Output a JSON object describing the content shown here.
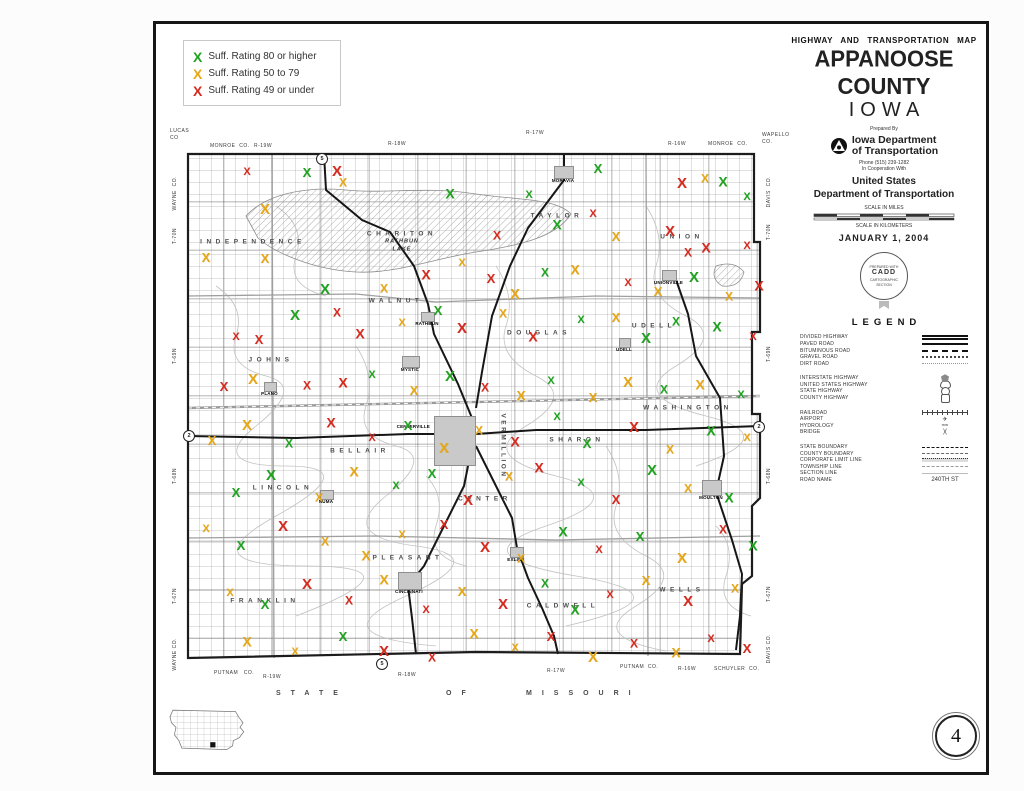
{
  "sheet": {
    "page_number": "4"
  },
  "suff_legend": {
    "items": [
      {
        "x_color": "#1fa31f",
        "label": "Suff. Rating 80 or higher"
      },
      {
        "x_color": "#e7a715",
        "label": "Suff. Rating 50 to 79"
      },
      {
        "x_color": "#d62a1f",
        "label": "Suff. Rating 49 or under"
      }
    ]
  },
  "title_block": {
    "map_type": "HIGHWAY AND TRANSPORTATION MAP",
    "county": "APPANOOSE COUNTY",
    "state": "IOWA",
    "prepared_by": "Prepared By",
    "agency_line1": "Iowa Department",
    "agency_line2": "of Transportation",
    "phone": "Phone (515) 239-1282",
    "cooperation": "In Cooperation With",
    "us_line1": "United States",
    "us_line2": "Department of Transportation",
    "scale_miles": "SCALE IN MILES",
    "scale_km": "SCALE IN KILOMETERS",
    "date": "JANUARY 1, 2004",
    "seal_line1": "PREPARED WITH",
    "seal_line2": "CADD",
    "seal_line3": "CARTOGRAPHIC",
    "seal_line4": "SECTION"
  },
  "legend": {
    "heading": "LEGEND",
    "groups": [
      {
        "items": [
          {
            "label": "DIVIDED HIGHWAY",
            "sym": "divided"
          },
          {
            "label": "PAVED ROAD",
            "sym": "paved"
          },
          {
            "label": "BITUMINOUS ROAD",
            "sym": "bituminous"
          },
          {
            "label": "GRAVEL ROAD",
            "sym": "gravel"
          },
          {
            "label": "DIRT ROAD",
            "sym": "dirt"
          }
        ]
      },
      {
        "items": [
          {
            "label": "INTERSTATE HIGHWAY",
            "sym": "interstate"
          },
          {
            "label": "UNITED STATES HIGHWAY",
            "sym": "us"
          },
          {
            "label": "STATE HIGHWAY",
            "sym": "state"
          },
          {
            "label": "COUNTY HIGHWAY",
            "sym": "county"
          }
        ]
      },
      {
        "items": [
          {
            "label": "RAILROAD",
            "sym": "railroad"
          },
          {
            "label": "AIRPORT",
            "sym": "glyph",
            "glyph": "✈"
          },
          {
            "label": "HYDROLOGY",
            "sym": "glyph",
            "glyph": "≈≈"
          },
          {
            "label": "BRIDGE",
            "sym": "glyph",
            "glyph": ")("
          }
        ]
      },
      {
        "items": [
          {
            "label": "STATE BOUNDARY",
            "sym": "stateb"
          },
          {
            "label": "COUNTY BOUNDARY",
            "sym": "countyb"
          },
          {
            "label": "CORPORATE LIMIT LINE",
            "sym": "corp"
          },
          {
            "label": "TOWNSHIP LINE",
            "sym": "townline"
          },
          {
            "label": "SECTION LINE",
            "sym": "sectline"
          },
          {
            "label": "ROAD NAME",
            "sym": "glyph",
            "glyph": "240TH ST"
          }
        ]
      }
    ]
  },
  "map": {
    "townships": [
      {
        "n": "INDEPENDENCE",
        "x": 77,
        "y": 96
      },
      {
        "n": "CHARITON",
        "x": 226,
        "y": 88
      },
      {
        "n": "TAYLOR",
        "x": 381,
        "y": 70
      },
      {
        "n": "UNION",
        "x": 506,
        "y": 91
      },
      {
        "n": "JOHNS",
        "x": 95,
        "y": 214
      },
      {
        "n": "WALNUT",
        "x": 220,
        "y": 155
      },
      {
        "n": "DOUGLAS",
        "x": 363,
        "y": 187
      },
      {
        "n": "UDELL",
        "x": 478,
        "y": 180
      },
      {
        "n": "WASHINGTON",
        "x": 512,
        "y": 262
      },
      {
        "n": "LINCOLN",
        "x": 107,
        "y": 342
      },
      {
        "n": "BELLAIR",
        "x": 184,
        "y": 305
      },
      {
        "n": "VERMILLION",
        "x": 327,
        "y": 300,
        "vert": true
      },
      {
        "n": "SHARON",
        "x": 401,
        "y": 294
      },
      {
        "n": "CENTER",
        "x": 309,
        "y": 353
      },
      {
        "n": "PLEASANT",
        "x": 232,
        "y": 412
      },
      {
        "n": "FRANKLIN",
        "x": 89,
        "y": 455
      },
      {
        "n": "CALDWELL",
        "x": 387,
        "y": 460
      },
      {
        "n": "WELLS",
        "x": 506,
        "y": 444
      }
    ],
    "lake_label": {
      "line1": "RATHBUN",
      "line2": "LAKE",
      "x": 226,
      "y": 100
    },
    "towns": [
      {
        "n": "MORAVIA",
        "x": 378,
        "y": 20,
        "w": 18,
        "h": 11
      },
      {
        "n": "UNIONVILLE",
        "x": 486,
        "y": 124,
        "w": 13,
        "h": 9
      },
      {
        "n": "RATHBUN",
        "x": 245,
        "y": 166,
        "w": 12,
        "h": 8
      },
      {
        "n": "UDELL",
        "x": 443,
        "y": 192,
        "w": 10,
        "h": 8
      },
      {
        "n": "MYSTIC",
        "x": 226,
        "y": 210,
        "w": 16,
        "h": 10
      },
      {
        "n": "PLANO",
        "x": 88,
        "y": 236,
        "w": 11,
        "h": 8
      },
      {
        "n": "CENTERVILLE",
        "x": 258,
        "y": 270,
        "w": 40,
        "h": 48,
        "lp": "left"
      },
      {
        "n": "NUMA",
        "x": 144,
        "y": 344,
        "w": 12,
        "h": 8
      },
      {
        "n": "MOULTON",
        "x": 526,
        "y": 334,
        "w": 18,
        "h": 14
      },
      {
        "n": "EXLINE",
        "x": 334,
        "y": 401,
        "w": 12,
        "h": 9
      },
      {
        "n": "CINCINNATI",
        "x": 222,
        "y": 426,
        "w": 22,
        "h": 16
      }
    ],
    "route_shields": [
      {
        "n": "5",
        "x": 146,
        "y": 13
      },
      {
        "n": "2",
        "x": 13,
        "y": 290
      },
      {
        "n": "5",
        "x": 206,
        "y": 518
      },
      {
        "n": "2",
        "x": 583,
        "y": 281
      }
    ],
    "edges": {
      "top": [
        {
          "t": "LUCAS\nCO",
          "x": 0,
          "y": 4
        },
        {
          "t": "MONROE  CO.",
          "x": 40,
          "y": 19
        },
        {
          "t": "R-19W",
          "x": 84,
          "y": 19
        },
        {
          "t": "R-18W",
          "x": 218,
          "y": 17
        },
        {
          "t": "R-17W",
          "x": 356,
          "y": 6
        },
        {
          "t": "R-16W",
          "x": 498,
          "y": 17
        },
        {
          "t": "MONROE  CO.",
          "x": 538,
          "y": 17
        },
        {
          "t": "WAPELLO\nCO.",
          "x": 592,
          "y": 8
        }
      ],
      "bottom": [
        {
          "t": "PUTNAM   CO.",
          "x": 44,
          "y": 546
        },
        {
          "t": "R-19W",
          "x": 93,
          "y": 550
        },
        {
          "t": "R-18W",
          "x": 228,
          "y": 548
        },
        {
          "t": "R-17W",
          "x": 377,
          "y": 544
        },
        {
          "t": "PUTNAM  CO.",
          "x": 450,
          "y": 540
        },
        {
          "t": "R-16W",
          "x": 508,
          "y": 542
        },
        {
          "t": "SCHUYLER  CO.",
          "x": 544,
          "y": 542
        }
      ],
      "left": [
        {
          "t": "WAYNE  CO.",
          "x": 2,
          "y": 52
        },
        {
          "t": "T-70N",
          "x": 2,
          "y": 104
        },
        {
          "t": "T-69N",
          "x": 2,
          "y": 224
        },
        {
          "t": "T-68N",
          "x": 2,
          "y": 344
        },
        {
          "t": "T-67N",
          "x": 2,
          "y": 464
        },
        {
          "t": "WAYNE CO.",
          "x": 2,
          "y": 514
        }
      ],
      "right": [
        {
          "t": "DAVIS  CO.",
          "x": 596,
          "y": 52
        },
        {
          "t": "T-70N",
          "x": 596,
          "y": 100
        },
        {
          "t": "T-69N",
          "x": 596,
          "y": 222
        },
        {
          "t": "T-68N",
          "x": 596,
          "y": 344
        },
        {
          "t": "T-67N",
          "x": 596,
          "y": 462
        },
        {
          "t": "DAVIS CO.",
          "x": 596,
          "y": 510
        }
      ]
    },
    "missouri": {
      "y": 566,
      "parts": [
        {
          "t": "STATE",
          "x": 106
        },
        {
          "t": "OF",
          "x": 276
        },
        {
          "t": "MISSOURI",
          "x": 356
        }
      ]
    },
    "marks": [
      [
        71,
        27,
        "r"
      ],
      [
        131,
        27,
        "g"
      ],
      [
        161,
        26,
        "r"
      ],
      [
        167,
        37,
        "y"
      ],
      [
        274,
        48,
        "g"
      ],
      [
        353,
        50,
        "g"
      ],
      [
        422,
        23,
        "g"
      ],
      [
        506,
        38,
        "r"
      ],
      [
        529,
        33,
        "y"
      ],
      [
        547,
        36,
        "g"
      ],
      [
        571,
        52,
        "g"
      ],
      [
        30,
        112,
        "y"
      ],
      [
        89,
        64,
        "y"
      ],
      [
        321,
        90,
        "r"
      ],
      [
        381,
        79,
        "g"
      ],
      [
        417,
        69,
        "r"
      ],
      [
        440,
        91,
        "y"
      ],
      [
        494,
        86,
        "r"
      ],
      [
        512,
        107,
        "r"
      ],
      [
        530,
        102,
        "r"
      ],
      [
        571,
        101,
        "r"
      ],
      [
        89,
        113,
        "y"
      ],
      [
        149,
        144,
        "g"
      ],
      [
        208,
        143,
        "y"
      ],
      [
        250,
        129,
        "r"
      ],
      [
        286,
        118,
        "y"
      ],
      [
        315,
        133,
        "r"
      ],
      [
        339,
        149,
        "y"
      ],
      [
        369,
        127,
        "g"
      ],
      [
        399,
        124,
        "y"
      ],
      [
        452,
        138,
        "r"
      ],
      [
        482,
        146,
        "y"
      ],
      [
        518,
        132,
        "g"
      ],
      [
        553,
        151,
        "y"
      ],
      [
        583,
        140,
        "r"
      ],
      [
        60,
        192,
        "r"
      ],
      [
        83,
        194,
        "r"
      ],
      [
        119,
        170,
        "g"
      ],
      [
        161,
        167,
        "r"
      ],
      [
        184,
        188,
        "r"
      ],
      [
        226,
        178,
        "y"
      ],
      [
        262,
        165,
        "g"
      ],
      [
        286,
        183,
        "r"
      ],
      [
        327,
        168,
        "y"
      ],
      [
        357,
        191,
        "r"
      ],
      [
        405,
        175,
        "g"
      ],
      [
        440,
        172,
        "y"
      ],
      [
        470,
        193,
        "g"
      ],
      [
        500,
        176,
        "g"
      ],
      [
        541,
        181,
        "g"
      ],
      [
        577,
        192,
        "r"
      ],
      [
        48,
        241,
        "r"
      ],
      [
        77,
        234,
        "y"
      ],
      [
        131,
        240,
        "r"
      ],
      [
        167,
        237,
        "r"
      ],
      [
        196,
        230,
        "g"
      ],
      [
        238,
        245,
        "y"
      ],
      [
        274,
        231,
        "g"
      ],
      [
        309,
        242,
        "r"
      ],
      [
        345,
        250,
        "y"
      ],
      [
        375,
        236,
        "g"
      ],
      [
        417,
        252,
        "y"
      ],
      [
        452,
        237,
        "y"
      ],
      [
        488,
        244,
        "g"
      ],
      [
        524,
        239,
        "y"
      ],
      [
        565,
        250,
        "g"
      ],
      [
        36,
        295,
        "y"
      ],
      [
        71,
        280,
        "y"
      ],
      [
        113,
        298,
        "g"
      ],
      [
        155,
        277,
        "r"
      ],
      [
        196,
        293,
        "r"
      ],
      [
        232,
        280,
        "g"
      ],
      [
        268,
        303,
        "y"
      ],
      [
        303,
        285,
        "y"
      ],
      [
        339,
        296,
        "r"
      ],
      [
        381,
        272,
        "g"
      ],
      [
        411,
        298,
        "g"
      ],
      [
        458,
        282,
        "r"
      ],
      [
        494,
        304,
        "y"
      ],
      [
        535,
        285,
        "g"
      ],
      [
        571,
        293,
        "y"
      ],
      [
        60,
        347,
        "g"
      ],
      [
        95,
        330,
        "g"
      ],
      [
        143,
        352,
        "y"
      ],
      [
        178,
        326,
        "y"
      ],
      [
        220,
        341,
        "g"
      ],
      [
        256,
        328,
        "g"
      ],
      [
        292,
        355,
        "r"
      ],
      [
        333,
        331,
        "y"
      ],
      [
        363,
        322,
        "r"
      ],
      [
        405,
        338,
        "g"
      ],
      [
        440,
        354,
        "r"
      ],
      [
        476,
        325,
        "g"
      ],
      [
        512,
        343,
        "y"
      ],
      [
        553,
        352,
        "g"
      ],
      [
        30,
        384,
        "y"
      ],
      [
        65,
        400,
        "g"
      ],
      [
        107,
        381,
        "r"
      ],
      [
        149,
        396,
        "y"
      ],
      [
        190,
        410,
        "y"
      ],
      [
        226,
        390,
        "y"
      ],
      [
        268,
        379,
        "r"
      ],
      [
        309,
        402,
        "r"
      ],
      [
        345,
        413,
        "y"
      ],
      [
        387,
        386,
        "g"
      ],
      [
        423,
        405,
        "r"
      ],
      [
        464,
        391,
        "g"
      ],
      [
        506,
        413,
        "y"
      ],
      [
        547,
        384,
        "r"
      ],
      [
        577,
        400,
        "g"
      ],
      [
        54,
        448,
        "y"
      ],
      [
        89,
        459,
        "g"
      ],
      [
        131,
        439,
        "r"
      ],
      [
        173,
        455,
        "r"
      ],
      [
        208,
        434,
        "y"
      ],
      [
        250,
        465,
        "r"
      ],
      [
        286,
        446,
        "y"
      ],
      [
        327,
        459,
        "r"
      ],
      [
        369,
        438,
        "g"
      ],
      [
        399,
        464,
        "g"
      ],
      [
        434,
        450,
        "r"
      ],
      [
        470,
        435,
        "y"
      ],
      [
        512,
        456,
        "r"
      ],
      [
        559,
        443,
        "y"
      ],
      [
        71,
        496,
        "y"
      ],
      [
        119,
        507,
        "y"
      ],
      [
        167,
        491,
        "g"
      ],
      [
        208,
        506,
        "r"
      ],
      [
        256,
        512,
        "r"
      ],
      [
        298,
        488,
        "y"
      ],
      [
        339,
        503,
        "y"
      ],
      [
        375,
        491,
        "r"
      ],
      [
        417,
        512,
        "y"
      ],
      [
        458,
        498,
        "r"
      ],
      [
        500,
        507,
        "y"
      ],
      [
        535,
        494,
        "r"
      ],
      [
        571,
        503,
        "r"
      ]
    ]
  }
}
